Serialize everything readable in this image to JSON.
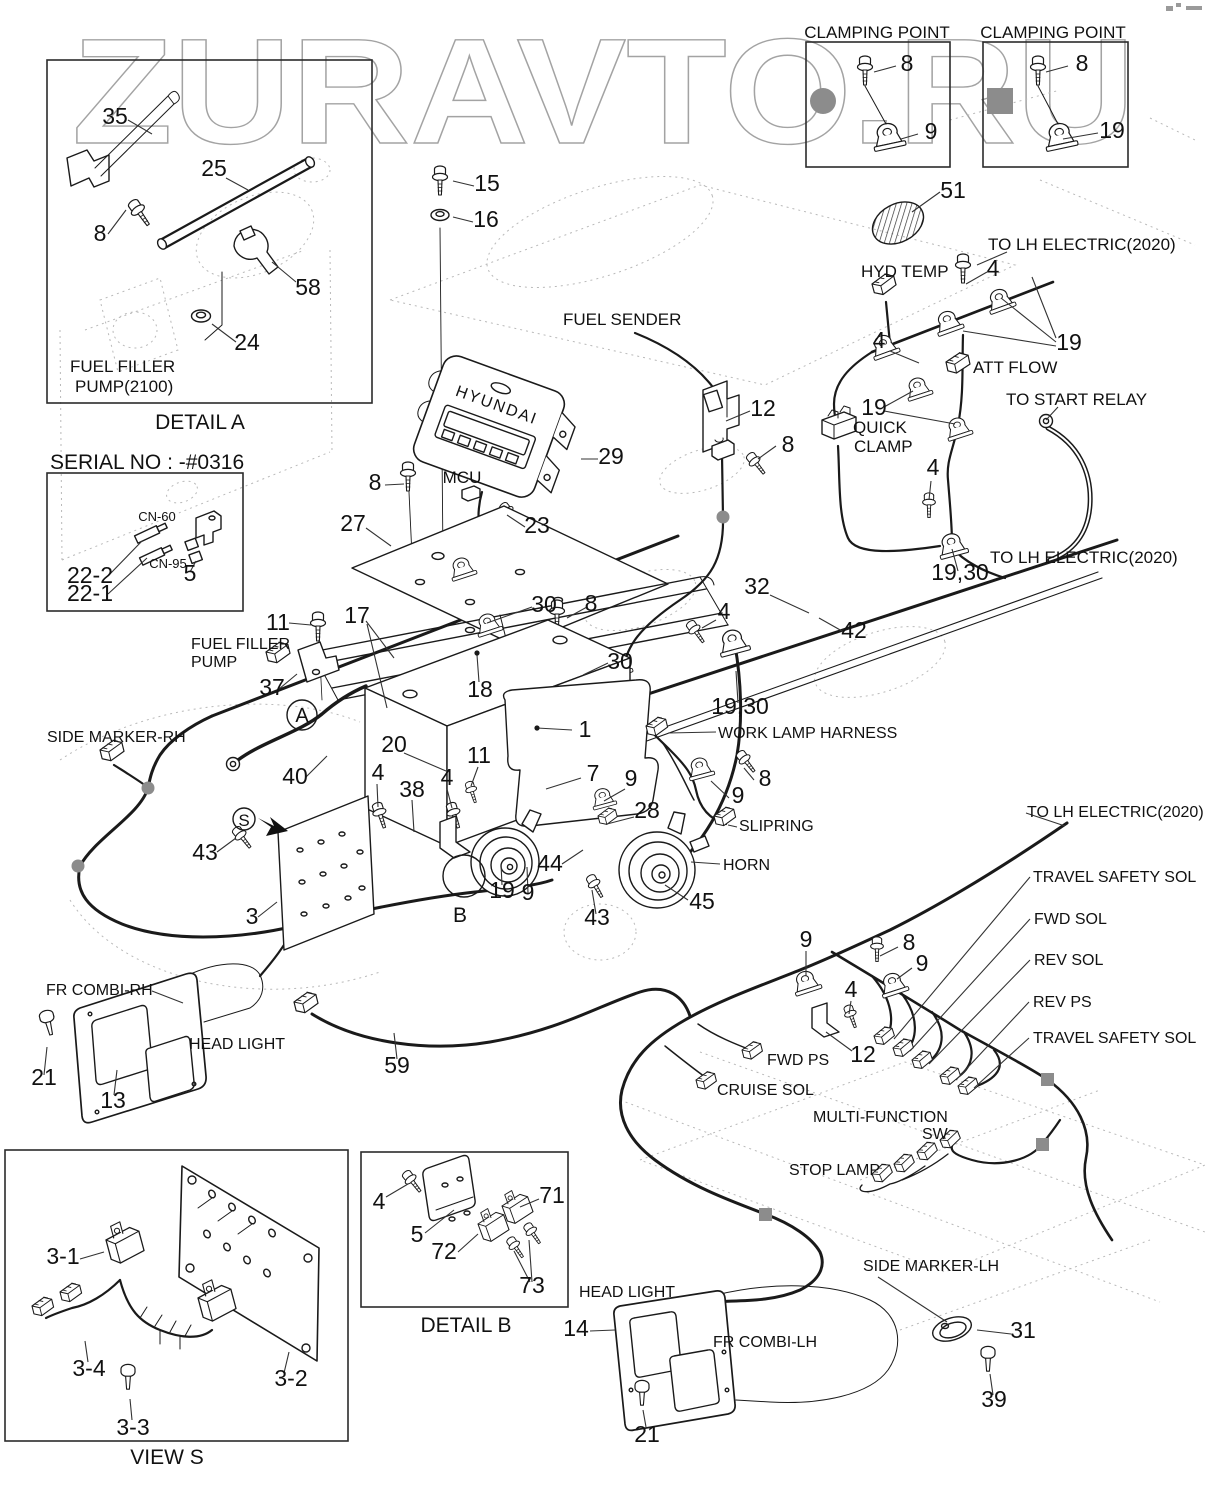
{
  "watermark": {
    "text": "ZURAVTO.RU"
  },
  "diagram": {
    "type": "exploded-parts-wiring-diagram",
    "insets": [
      {
        "id": "detail-a",
        "caption": "DETAIL  A",
        "subject": "FUEL FILLER PUMP(2100)"
      },
      {
        "id": "clamping-point-1",
        "caption": "CLAMPING POINT",
        "parts": [
          "8",
          "9"
        ]
      },
      {
        "id": "clamping-point-2",
        "caption": "CLAMPING POINT",
        "parts": [
          "8",
          "19"
        ]
      },
      {
        "id": "serial-note",
        "caption": "SERIAL NO : -#0316",
        "connectors": [
          "CN-60",
          "CN-95"
        ],
        "parts": [
          "22-2",
          "22-1",
          "5"
        ]
      },
      {
        "id": "detail-b",
        "caption": "DETAIL  B",
        "parts": [
          "4",
          "5",
          "71",
          "72",
          "73"
        ]
      },
      {
        "id": "view-s",
        "caption": "VIEW S",
        "parts": [
          "3-1",
          "3-2",
          "3-3",
          "3-4"
        ]
      }
    ]
  },
  "annotations": [
    {
      "t": "35",
      "x": 115,
      "y": 124
    },
    {
      "t": "25",
      "x": 214,
      "y": 176
    },
    {
      "t": "8",
      "x": 100,
      "y": 241
    },
    {
      "t": "58",
      "x": 308,
      "y": 295
    },
    {
      "t": "24",
      "x": 247,
      "y": 350
    },
    {
      "t": "FUEL FILLER",
      "x": 70,
      "y": 372,
      "fs": 17,
      "a": "s"
    },
    {
      "t": "PUMP(2100)",
      "x": 75,
      "y": 392,
      "fs": 17,
      "a": "s"
    },
    {
      "t": "DETAIL  A",
      "x": 200,
      "y": 429,
      "fs": 21
    },
    {
      "t": "CLAMPING POINT",
      "x": 877,
      "y": 38,
      "fs": 17
    },
    {
      "t": "CLAMPING POINT",
      "x": 1053,
      "y": 38,
      "fs": 17
    },
    {
      "t": "8",
      "x": 907,
      "y": 71
    },
    {
      "t": "9",
      "x": 931,
      "y": 139
    },
    {
      "t": "8",
      "x": 1082,
      "y": 71
    },
    {
      "t": "19",
      "x": 1112,
      "y": 138
    },
    {
      "t": "51",
      "x": 953,
      "y": 198
    },
    {
      "t": "TO LH ELECTRIC(2020)",
      "x": 988,
      "y": 250,
      "fs": 17,
      "a": "s"
    },
    {
      "t": "HYD TEMP",
      "x": 861,
      "y": 277,
      "fs": 17,
      "a": "s"
    },
    {
      "t": "4",
      "x": 993,
      "y": 276
    },
    {
      "t": "19",
      "x": 1069,
      "y": 350
    },
    {
      "t": "4",
      "x": 879,
      "y": 348
    },
    {
      "t": "ATT FLOW",
      "x": 973,
      "y": 373,
      "fs": 17,
      "a": "s"
    },
    {
      "t": "TO START RELAY",
      "x": 1006,
      "y": 405,
      "fs": 17,
      "a": "s"
    },
    {
      "t": "19",
      "x": 874,
      "y": 415
    },
    {
      "t": "QUICK",
      "x": 853,
      "y": 433,
      "fs": 17,
      "a": "s"
    },
    {
      "t": "CLAMP",
      "x": 854,
      "y": 452,
      "fs": 17,
      "a": "s"
    },
    {
      "t": "4",
      "x": 933,
      "y": 475
    },
    {
      "t": "19,30",
      "x": 960,
      "y": 580
    },
    {
      "t": "TO LH ELECTRIC(2020)",
      "x": 990,
      "y": 563,
      "fs": 17,
      "a": "s"
    },
    {
      "t": "SERIAL NO : -#0316",
      "x": 50,
      "y": 469,
      "fs": 21,
      "a": "s"
    },
    {
      "t": "CN-60",
      "x": 157,
      "y": 521,
      "fs": 13
    },
    {
      "t": "CN-95",
      "x": 168,
      "y": 568,
      "fs": 13
    },
    {
      "t": "22-2",
      "x": 90,
      "y": 583
    },
    {
      "t": "22-1",
      "x": 90,
      "y": 601
    },
    {
      "t": "5",
      "x": 190,
      "y": 581
    },
    {
      "t": "15",
      "x": 487,
      "y": 191
    },
    {
      "t": "16",
      "x": 486,
      "y": 227
    },
    {
      "t": "FUEL SENDER",
      "x": 563,
      "y": 325,
      "fs": 17,
      "a": "s"
    },
    {
      "t": "12",
      "x": 763,
      "y": 416
    },
    {
      "t": "8",
      "x": 788,
      "y": 452
    },
    {
      "t": "29",
      "x": 611,
      "y": 464
    },
    {
      "t": "MCU",
      "x": 462,
      "y": 483,
      "fs": 17
    },
    {
      "t": "8",
      "x": 375,
      "y": 490
    },
    {
      "t": "23",
      "x": 537,
      "y": 533
    },
    {
      "t": "27",
      "x": 353,
      "y": 531
    },
    {
      "t": "30",
      "x": 544,
      "y": 612
    },
    {
      "t": "8",
      "x": 591,
      "y": 611
    },
    {
      "t": "30",
      "x": 620,
      "y": 669
    },
    {
      "t": "17",
      "x": 357,
      "y": 623
    },
    {
      "t": "18",
      "x": 480,
      "y": 697
    },
    {
      "t": "11",
      "x": 278,
      "y": 630
    },
    {
      "t": "FUEL FILLER",
      "x": 191,
      "y": 649,
      "fs": 16,
      "a": "s"
    },
    {
      "t": "PUMP",
      "x": 191,
      "y": 667,
      "fs": 16,
      "a": "s"
    },
    {
      "t": "37",
      "x": 272,
      "y": 695
    },
    {
      "t": "A",
      "x": 302,
      "y": 722,
      "fs": 20
    },
    {
      "t": "SIDE MARKER-RH",
      "x": 47,
      "y": 742,
      "fs": 16,
      "a": "s"
    },
    {
      "t": "1",
      "x": 585,
      "y": 737
    },
    {
      "t": "20",
      "x": 394,
      "y": 752
    },
    {
      "t": "40",
      "x": 295,
      "y": 784
    },
    {
      "t": "4",
      "x": 378,
      "y": 780
    },
    {
      "t": "38",
      "x": 412,
      "y": 797
    },
    {
      "t": "4",
      "x": 447,
      "y": 785
    },
    {
      "t": "11",
      "x": 479,
      "y": 763
    },
    {
      "t": "7",
      "x": 593,
      "y": 781
    },
    {
      "t": "9",
      "x": 631,
      "y": 786
    },
    {
      "t": "28",
      "x": 647,
      "y": 818
    },
    {
      "t": "S",
      "x": 244,
      "y": 826,
      "fs": 17
    },
    {
      "t": "43",
      "x": 205,
      "y": 860
    },
    {
      "t": "3",
      "x": 252,
      "y": 924
    },
    {
      "t": "19",
      "x": 502,
      "y": 898
    },
    {
      "t": "9",
      "x": 528,
      "y": 900
    },
    {
      "t": "B",
      "x": 460,
      "y": 922,
      "fs": 21
    },
    {
      "t": "43",
      "x": 597,
      "y": 925
    },
    {
      "t": "44",
      "x": 550,
      "y": 871
    },
    {
      "t": "45",
      "x": 702,
      "y": 909
    },
    {
      "t": "HORN",
      "x": 723,
      "y": 870,
      "fs": 16,
      "a": "s"
    },
    {
      "t": "SLIPRING",
      "x": 739,
      "y": 831,
      "fs": 16,
      "a": "s"
    },
    {
      "t": "WORK LAMP HARNESS",
      "x": 718,
      "y": 738,
      "fs": 16,
      "a": "s"
    },
    {
      "t": "8",
      "x": 765,
      "y": 786
    },
    {
      "t": "9",
      "x": 738,
      "y": 803
    },
    {
      "t": "19,30",
      "x": 740,
      "y": 714
    },
    {
      "t": "32",
      "x": 757,
      "y": 594
    },
    {
      "t": "42",
      "x": 854,
      "y": 638
    },
    {
      "t": "4",
      "x": 724,
      "y": 619
    },
    {
      "t": "FR COMBI-RH",
      "x": 46,
      "y": 995,
      "fs": 16,
      "a": "s"
    },
    {
      "t": "HEAD LIGHT",
      "x": 189,
      "y": 1049,
      "fs": 16,
      "a": "s"
    },
    {
      "t": "21",
      "x": 44,
      "y": 1085
    },
    {
      "t": "13",
      "x": 113,
      "y": 1108
    },
    {
      "t": "59",
      "x": 397,
      "y": 1073
    },
    {
      "t": "TO LH ELECTRIC(2020)",
      "x": 1027,
      "y": 817,
      "fs": 16,
      "a": "s"
    },
    {
      "t": "TRAVEL SAFETY SOL",
      "x": 1033,
      "y": 882,
      "fs": 16,
      "a": "s"
    },
    {
      "t": "FWD SOL",
      "x": 1034,
      "y": 924,
      "fs": 16,
      "a": "s"
    },
    {
      "t": "REV SOL",
      "x": 1034,
      "y": 965,
      "fs": 16,
      "a": "s"
    },
    {
      "t": "REV PS",
      "x": 1033,
      "y": 1007,
      "fs": 16,
      "a": "s"
    },
    {
      "t": "TRAVEL SAFETY SOL",
      "x": 1033,
      "y": 1043,
      "fs": 16,
      "a": "s"
    },
    {
      "t": "9",
      "x": 806,
      "y": 947
    },
    {
      "t": "8",
      "x": 909,
      "y": 950
    },
    {
      "t": "9",
      "x": 922,
      "y": 971
    },
    {
      "t": "4",
      "x": 851,
      "y": 997
    },
    {
      "t": "12",
      "x": 863,
      "y": 1062
    },
    {
      "t": "FWD PS",
      "x": 767,
      "y": 1065,
      "fs": 16,
      "a": "s"
    },
    {
      "t": "CRUISE SOL",
      "x": 717,
      "y": 1095,
      "fs": 16,
      "a": "s"
    },
    {
      "t": "MULTI-FUNCTION",
      "x": 813,
      "y": 1122,
      "fs": 16,
      "a": "s"
    },
    {
      "t": "SW",
      "x": 922,
      "y": 1139,
      "fs": 16,
      "a": "s"
    },
    {
      "t": "STOP LAMP",
      "x": 789,
      "y": 1175,
      "fs": 16,
      "a": "s"
    },
    {
      "t": "SIDE MARKER-LH",
      "x": 863,
      "y": 1271,
      "fs": 16,
      "a": "s"
    },
    {
      "t": "31",
      "x": 1023,
      "y": 1338
    },
    {
      "t": "39",
      "x": 994,
      "y": 1407
    },
    {
      "t": "HEAD LIGHT",
      "x": 579,
      "y": 1297,
      "fs": 16,
      "a": "s"
    },
    {
      "t": "14",
      "x": 576,
      "y": 1336
    },
    {
      "t": "FR COMBI-LH",
      "x": 713,
      "y": 1347,
      "fs": 16,
      "a": "s"
    },
    {
      "t": "21",
      "x": 647,
      "y": 1442
    },
    {
      "t": "4",
      "x": 379,
      "y": 1209
    },
    {
      "t": "71",
      "x": 552,
      "y": 1203
    },
    {
      "t": "5",
      "x": 417,
      "y": 1242
    },
    {
      "t": "72",
      "x": 444,
      "y": 1259
    },
    {
      "t": "73",
      "x": 532,
      "y": 1293
    },
    {
      "t": "DETAIL  B",
      "x": 466,
      "y": 1332,
      "fs": 21
    },
    {
      "t": "3-1",
      "x": 63,
      "y": 1264
    },
    {
      "t": "3-4",
      "x": 89,
      "y": 1376
    },
    {
      "t": "3-3",
      "x": 133,
      "y": 1435
    },
    {
      "t": "3-2",
      "x": 291,
      "y": 1386
    },
    {
      "t": "VIEW S",
      "x": 167,
      "y": 1464,
      "fs": 21
    },
    {
      "t": "HYUNDAI",
      "x": 495,
      "y": 410,
      "fs": 16,
      "r": 20,
      "ls": 2
    }
  ]
}
